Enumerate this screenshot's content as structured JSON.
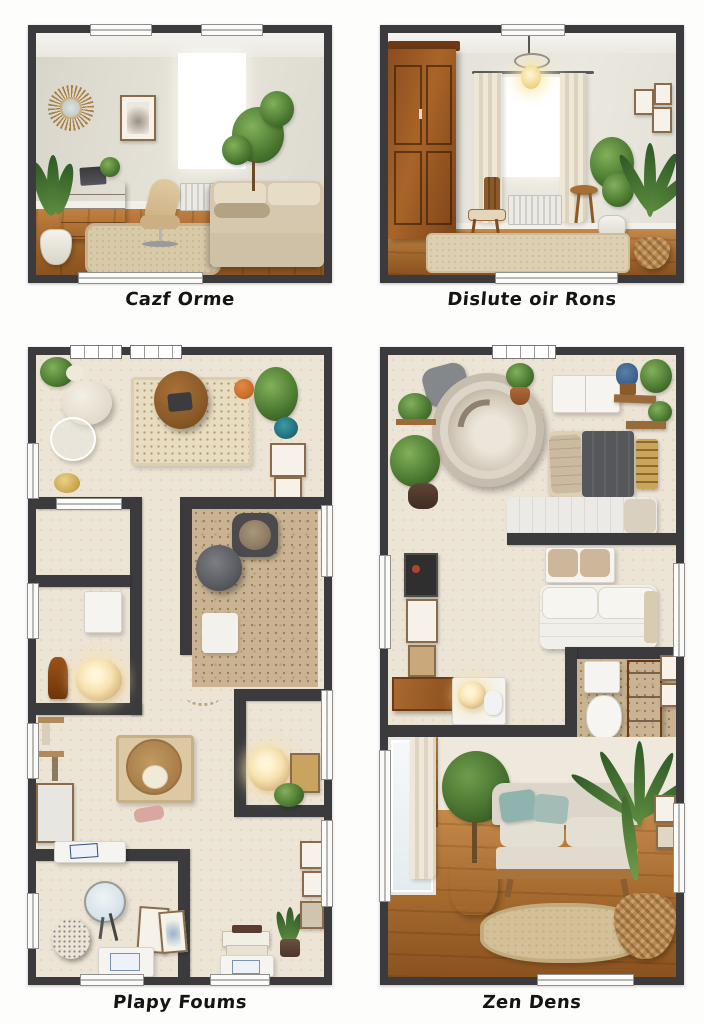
{
  "panels": [
    {
      "id": "render-top-left",
      "caption": "Cazf Orme"
    },
    {
      "id": "render-top-right",
      "caption": "Dislute oir Rons"
    },
    {
      "id": "floorplan-bottom-left",
      "caption": "Plapy Foums"
    },
    {
      "id": "floorplan-bottom-right",
      "caption": "Zen Dens"
    }
  ],
  "colors": {
    "background": "#fdfdfc",
    "frame_wall": "#3b3b3d",
    "caption_text": "#141414",
    "plan_floor": "#ece4d5",
    "speckled_floor": "#c9b392",
    "wood_floor": "#a9681f",
    "plant_green": "#4e7c33",
    "sofa_beige": "#d8cbb2",
    "wardrobe_brown": "#8a4d1f",
    "lamp_glow": "#f6e2ae",
    "teal_accent": "#1e6e7a"
  }
}
